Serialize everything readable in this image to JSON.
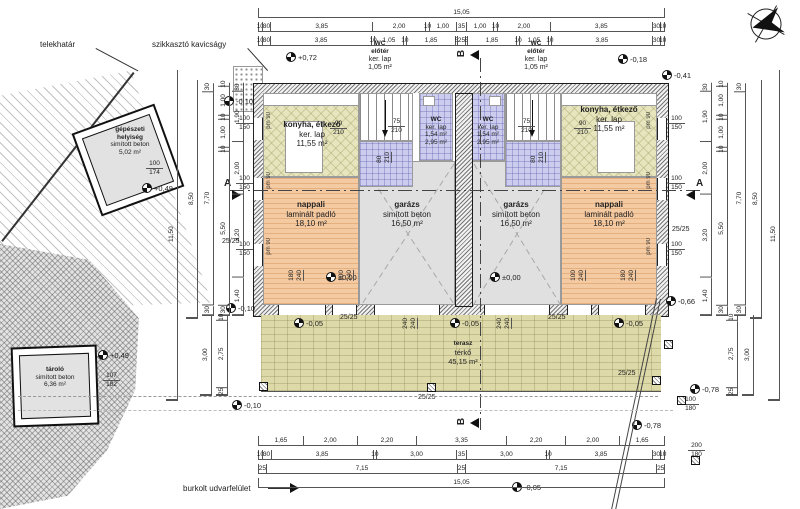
{
  "title_labels": {
    "telekhatar": "telekhatár",
    "szikkaszto_kavicsagy": "szikkasztó kavicságy",
    "burkolt_udvarfelulet": "burkolt udvarfelület"
  },
  "watermark": {
    "mono": "OC",
    "line1": "OTTHON",
    "line2": "CENTRUM"
  },
  "section_markers": {
    "a": "A",
    "b": "B"
  },
  "icons": {
    "north": "north-arrow"
  },
  "rooms": {
    "gepeszeti": {
      "name": "gépészeti",
      "name2": "helyiség",
      "floor": "simított beton",
      "area": "5,02 m²"
    },
    "tarolo": {
      "name": "tároló",
      "floor": "simított beton",
      "area": "6,36 m²"
    },
    "terasz": {
      "name": "terasz",
      "floor": "térkő",
      "area": "45,15 m²"
    },
    "left": {
      "konyha": {
        "name": "konyha, étkező",
        "floor": "ker. lap",
        "area": "11,55 m²"
      },
      "nappali": {
        "name": "nappali",
        "floor": "laminált padló",
        "area": "18,10 m²"
      },
      "garazs": {
        "name": "garázs",
        "floor": "simított beton",
        "area": "16,50 m²"
      },
      "wc": {
        "name": "WC",
        "floor": "ker. lap",
        "area": "1,54 m²",
        "eloter_area": "2,95 m²"
      },
      "wc_eloter": {
        "name": "WC",
        "name2": "előtér",
        "floor": "ker. lap",
        "area": "1,05 m²"
      }
    },
    "right": {
      "konyha": {
        "name": "konyha, étkező",
        "floor": "ker. lap",
        "area": "11,55 m²"
      },
      "nappali": {
        "name": "nappali",
        "floor": "laminált padló",
        "area": "18,10 m²"
      },
      "garazs": {
        "name": "garázs",
        "floor": "simított beton",
        "area": "16,50 m²"
      },
      "wc": {
        "name": "WC",
        "floor": "ker. lap",
        "area": "1,54 m²",
        "eloter_area": "2,95 m²"
      },
      "wc_eloter": {
        "name": "WC",
        "name2": "előtér",
        "floor": "ker. lap",
        "area": "1,05 m²"
      }
    }
  },
  "levels": {
    "l1": "+0,72",
    "l2": "-0,10",
    "l3": "-0,18",
    "l4": "-0,41",
    "l5": "+0,49",
    "l6": "+0,49",
    "l7": "±0,00",
    "l8": "±0,00",
    "l9": "-0,05",
    "l10": "-0,05",
    "l11": "-0,05",
    "l12": "-0,66",
    "l13": "-0,78",
    "l14": "-0,78",
    "l15": "-0,05",
    "l16": "-0,10",
    "l17": "-0,10"
  },
  "openings": {
    "w100": "100",
    "h150": "150",
    "pm90": "pm 90",
    "w90": "90",
    "w75": "75",
    "w80": "80",
    "h210": "210",
    "w180": "180",
    "w100b": "100",
    "h240": "240",
    "w240": "240",
    "gep_w": "100",
    "gep_h": "174",
    "tar_w": "107",
    "tar_h": "182",
    "fence_w1": "100",
    "fence_w2": "200",
    "fence_h": "180"
  },
  "columns": {
    "label": "25/25"
  },
  "dims": {
    "top_total": [
      {
        "t": "15,05",
        "w": 15.05
      }
    ],
    "top_row2": [
      {
        "t": "10",
        "w": 0.1
      },
      {
        "t": "30",
        "w": 0.3
      },
      {
        "t": "3,85",
        "w": 3.85
      },
      {
        "t": "2,00",
        "w": 2.0
      },
      {
        "t": "10",
        "w": 0.1
      },
      {
        "t": "1,00",
        "w": 1.0
      },
      {
        "t": "35",
        "w": 0.35
      },
      {
        "t": "1,00",
        "w": 1.0
      },
      {
        "t": "10",
        "w": 0.1
      },
      {
        "t": "2,00",
        "w": 2.0
      },
      {
        "t": "3,85",
        "w": 3.85
      },
      {
        "t": "30",
        "w": 0.3
      },
      {
        "t": "10",
        "w": 0.1
      }
    ],
    "top_row3": [
      {
        "t": "10",
        "w": 0.1
      },
      {
        "t": "30",
        "w": 0.3
      },
      {
        "t": "3,85",
        "w": 3.85
      },
      {
        "t": "10",
        "w": 0.1
      },
      {
        "t": "1,05",
        "w": 1.05
      },
      {
        "t": "10",
        "w": 0.1
      },
      {
        "t": "1,85",
        "w": 1.85
      },
      {
        "t": "5",
        "w": 0.05
      },
      {
        "t": "25",
        "w": 0.25
      },
      {
        "t": "5",
        "w": 0.05
      },
      {
        "t": "1,85",
        "w": 1.85
      },
      {
        "t": "10",
        "w": 0.1
      },
      {
        "t": "1,05",
        "w": 1.05
      },
      {
        "t": "10",
        "w": 0.1
      },
      {
        "t": "3,85",
        "w": 3.85
      },
      {
        "t": "30",
        "w": 0.3
      },
      {
        "t": "10",
        "w": 0.1
      }
    ],
    "bottom_row1": [
      {
        "t": "1,65",
        "w": 1.65
      },
      {
        "t": "2,00",
        "w": 2.0
      },
      {
        "t": "2,20",
        "w": 2.2
      },
      {
        "t": "3,35",
        "w": 3.35
      },
      {
        "t": "2,20",
        "w": 2.2
      },
      {
        "t": "2,00",
        "w": 2.0
      },
      {
        "t": "1,65",
        "w": 1.65
      }
    ],
    "bottom_row2": [
      {
        "t": "10",
        "w": 0.1
      },
      {
        "t": "30",
        "w": 0.3
      },
      {
        "t": "3,85",
        "w": 3.85
      },
      {
        "t": "10",
        "w": 0.1
      },
      {
        "t": "3,00",
        "w": 3.0
      },
      {
        "t": "35",
        "w": 0.35
      },
      {
        "t": "3,00",
        "w": 3.0
      },
      {
        "t": "10",
        "w": 0.1
      },
      {
        "t": "3,85",
        "w": 3.85
      },
      {
        "t": "30",
        "w": 0.3
      },
      {
        "t": "10",
        "w": 0.1
      }
    ],
    "bottom_row3": [
      {
        "t": "25",
        "w": 0.25
      },
      {
        "t": "7,15",
        "w": 7.15
      },
      {
        "t": "25",
        "w": 0.25
      },
      {
        "t": "7,15",
        "w": 7.15
      },
      {
        "t": "25",
        "w": 0.25
      }
    ],
    "bottom_total": [
      {
        "t": "15,05",
        "w": 15.05
      }
    ],
    "side_inner": [
      {
        "t": "30",
        "w": 0.3
      },
      {
        "t": "1,90",
        "w": 1.9
      },
      {
        "t": "2,00",
        "w": 2.0
      },
      {
        "t": "3,20",
        "w": 3.2
      },
      {
        "t": "1,40",
        "w": 1.4
      }
    ],
    "side_mid": [
      {
        "t": "10",
        "w": 0.1
      },
      {
        "t": "1,00",
        "w": 1.0
      },
      {
        "t": "10",
        "w": 0.1
      },
      {
        "t": "1,00",
        "w": 1.0
      },
      {
        "t": "10",
        "w": 0.1
      },
      {
        "t": "5,50",
        "w": 5.5
      },
      {
        "t": "30",
        "w": 0.3
      }
    ],
    "side_770": [
      {
        "t": "30",
        "w": 0.3
      },
      {
        "t": "7,70",
        "w": 7.7
      },
      {
        "t": "30",
        "w": 0.3
      }
    ],
    "side_850": [
      {
        "t": "8,50",
        "w": 8.5
      }
    ],
    "side_1150": [
      {
        "t": "11,50",
        "w": 11.5
      }
    ],
    "side_bottom_300": [
      {
        "t": "3,00",
        "w": 3.0
      }
    ],
    "side_bottom_275": [
      {
        "t": "10",
        "w": 0.2
      },
      {
        "t": "2,75",
        "w": 2.75
      },
      {
        "t": "25",
        "w": 0.25
      }
    ]
  }
}
